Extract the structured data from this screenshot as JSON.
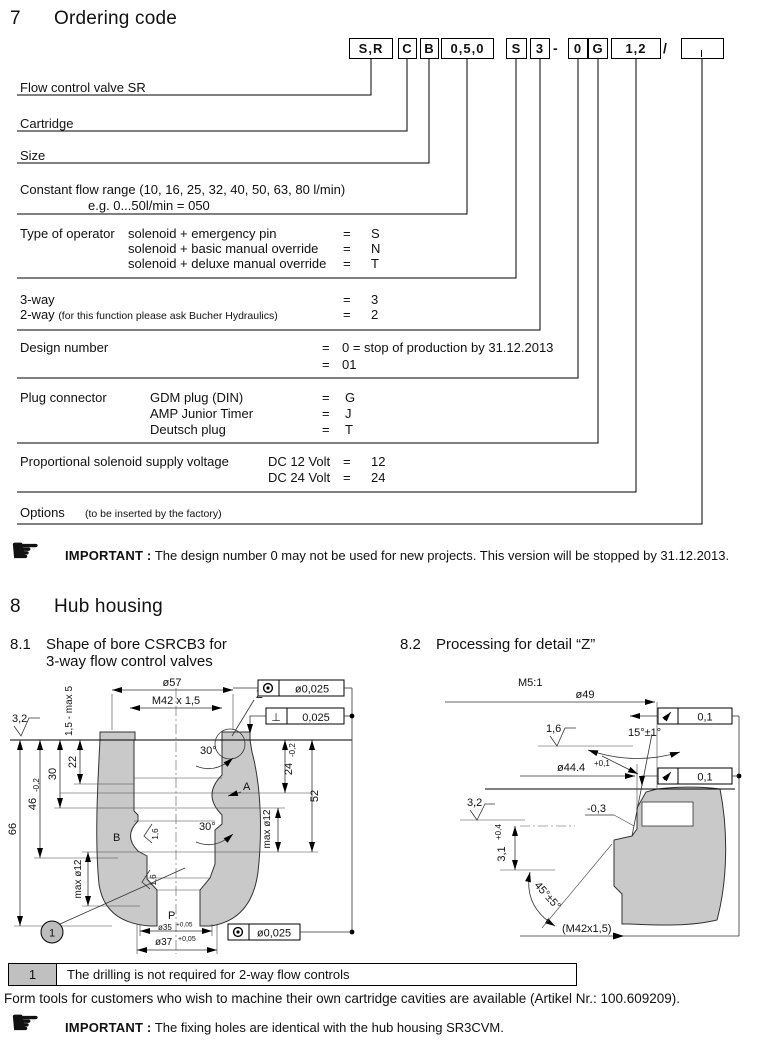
{
  "sections": {
    "s7": {
      "num": "7",
      "title": "Ordering code"
    },
    "s8": {
      "num": "8",
      "title": "Hub housing"
    },
    "s81": {
      "num": "8.1",
      "title1": "Shape of bore CSRCB3 for",
      "title2": "3-way  flow control valves"
    },
    "s82": {
      "num": "8.2",
      "title": "Processing for detail “Z”"
    }
  },
  "ordering": {
    "boxes": [
      "S,R",
      "C",
      "B",
      "0,5,0",
      "S",
      "3",
      "0",
      "G",
      "1,2",
      ""
    ],
    "sep_dash": "-",
    "sep_slash": "/",
    "rows": [
      {
        "label": "Flow control valve SR"
      },
      {
        "label": "Cartridge"
      },
      {
        "label": "Size"
      },
      {
        "label": "Constant flow range (10, 16, 25, 32, 40, 50, 63, 80 l/min)",
        "example": "e.g. 0...50l/min = 050"
      },
      {
        "label": "Type of operator",
        "options": [
          {
            "text": "solenoid + emergency pin",
            "eq": "=",
            "code": "S"
          },
          {
            "text": "solenoid + basic manual override",
            "eq": "=",
            "code": "N"
          },
          {
            "text": "solenoid + deluxe manual override",
            "eq": "=",
            "code": "T"
          }
        ]
      },
      {
        "options": [
          {
            "text": "3-way",
            "eq": "=",
            "code": "3"
          },
          {
            "text": "2-way",
            "note": "(for this function please ask Bucher Hydraulics)",
            "eq": "=",
            "code": "2"
          }
        ]
      },
      {
        "label": "Design number",
        "options": [
          {
            "eq": "=",
            "code": "0 = stop of production by 31.12.2013"
          },
          {
            "eq": "=",
            "code": "01"
          }
        ]
      },
      {
        "label": "Plug connector",
        "options": [
          {
            "text": "GDM plug (DIN)",
            "eq": "=",
            "code": "G"
          },
          {
            "text": "AMP Junior Timer",
            "eq": "=",
            "code": "J"
          },
          {
            "text": "Deutsch plug",
            "eq": "=",
            "code": "T"
          }
        ]
      },
      {
        "label": "Proportional solenoid supply voltage",
        "options": [
          {
            "text": "DC 12 Volt",
            "eq": "=",
            "code": "12"
          },
          {
            "text": "DC 24 Volt",
            "eq": "=",
            "code": "24"
          }
        ]
      },
      {
        "label": "Options",
        "note": "(to be inserted by the factory)"
      }
    ]
  },
  "important1": {
    "label": "IMPORTANT :",
    "text": "The design number 0 may not be used for new projects. This version will be stopped by 31.12.2013."
  },
  "important2": {
    "label": "IMPORTANT :",
    "text": "The fixing holes are identical with the hub housing SR3CVM."
  },
  "note_row": {
    "num": "1",
    "text": "The drilling is not required for 2-way flow controls"
  },
  "form_tools": "Form tools for customers who wish to machine their own cartridge cavities are available (Artikel Nr.: 100.609209).",
  "d81": {
    "dia57": "ø57",
    "thread": "M42 x 1,5",
    "z": "Z",
    "tol_top": "ø0,025",
    "tol_perp": "⊥",
    "tol_perp_val": "0,025",
    "tol_bottom": "ø0,025",
    "depth": "1,5 - max 5",
    "rough32": "3,2",
    "dim22": "22",
    "dim30": "30",
    "dim46": "46",
    "dim46_tol": "-0,2",
    "dim66": "66",
    "dim24": "24",
    "dim24_tol": "-0,2",
    "dim52": "52",
    "max12_left": "max ø12",
    "max12_right": "max ø12",
    "ang30_top": "30°",
    "ang30_bot": "30°",
    "port_a": "A",
    "port_b": "B",
    "port_p": "P",
    "rough16_a": "1,6",
    "rough16_b": "1,6",
    "dia35": "ø35",
    "dia35_tol": "+0,05",
    "dia37": "ø37",
    "dia37_tol": "+0,05",
    "balloon": "1"
  },
  "d82": {
    "scale": "M5:1",
    "dia49": "ø49",
    "rough16": "1,6",
    "ang15": "15°±1°",
    "dia444": "ø44.4",
    "dia444_tol": "+0,1",
    "tol_runout1": "0,1",
    "tol_runout2": "0,1",
    "rough32": "3,2",
    "minus03": "-0,3",
    "dim31": "3,1",
    "dim31_tol": "+0,4",
    "ang45": "45°±5°",
    "thread_ref": "(M42x1,5)"
  }
}
